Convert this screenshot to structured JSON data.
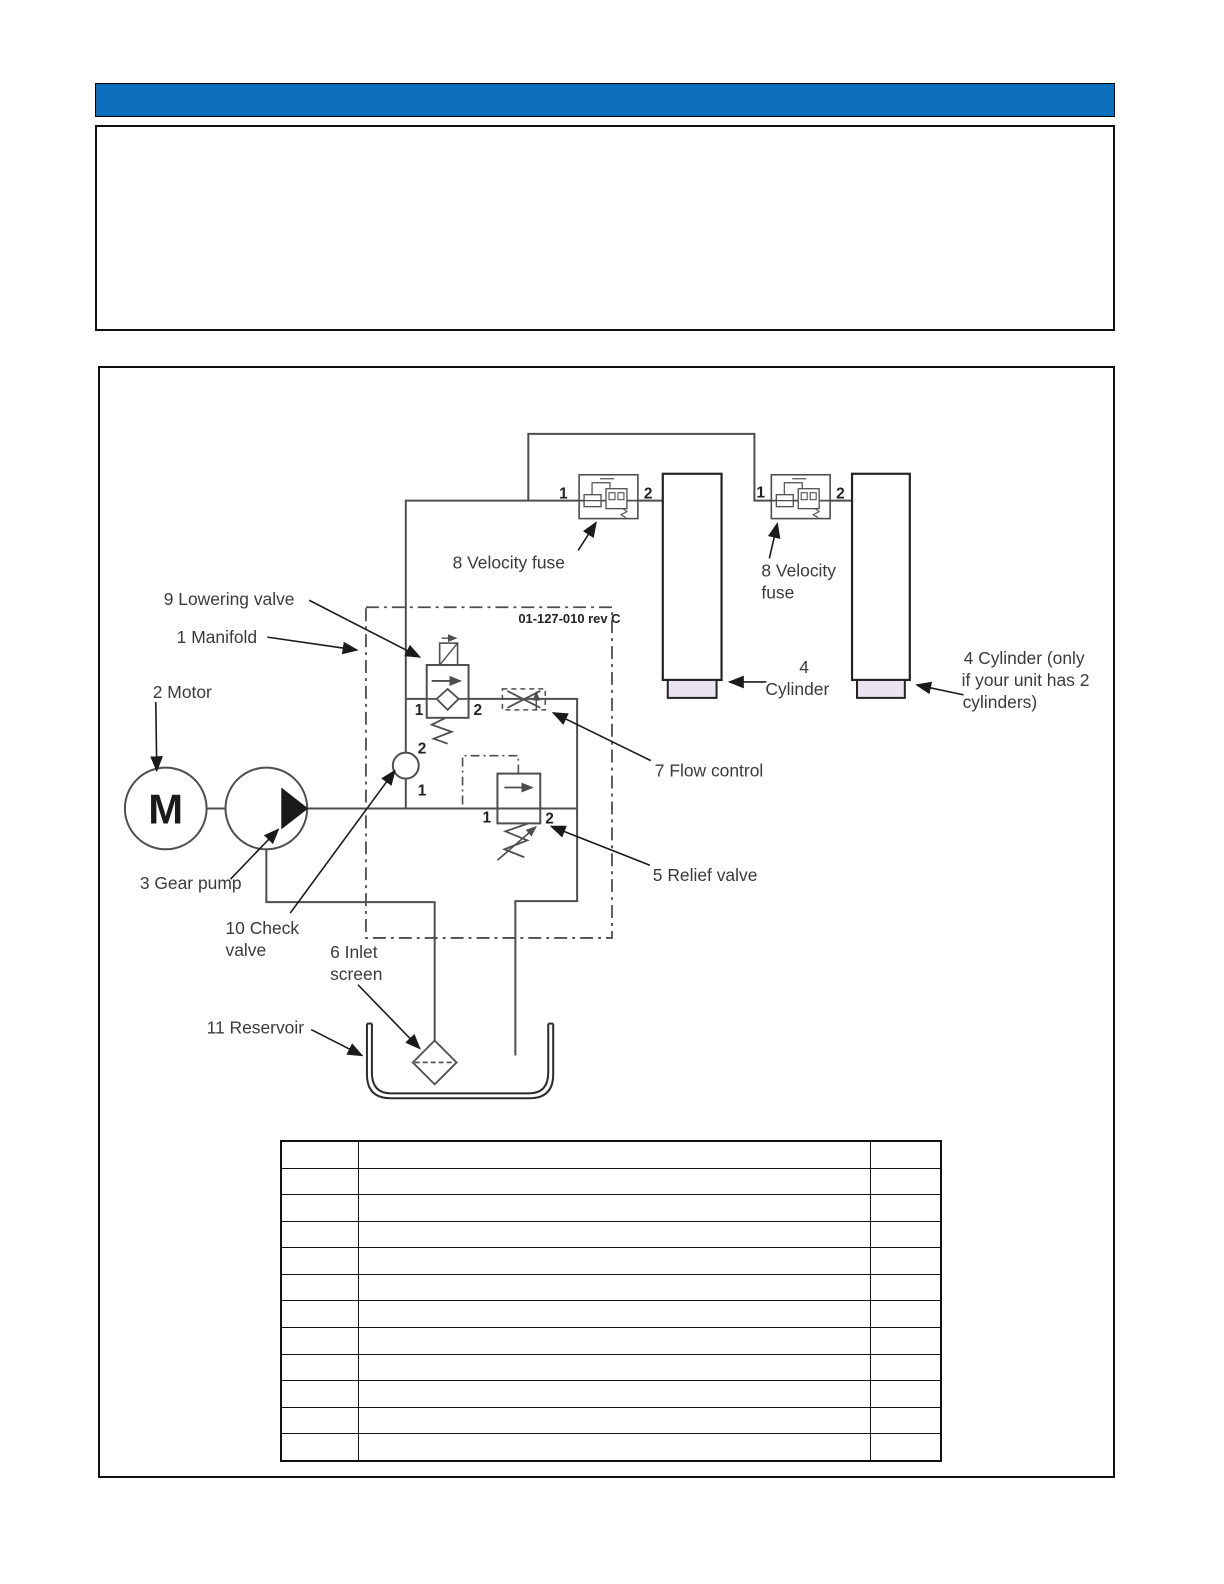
{
  "header": {
    "bar_color": "#0b6fbd"
  },
  "colors": {
    "accent_blue": "#0b6fbd",
    "line_gray": "#4e4e4e",
    "ink": "#1a1a1a",
    "gland_fill": "#e9e4ef"
  },
  "diagram": {
    "drawing_number": "01-127-010 rev C",
    "labels": {
      "lowering_valve": "9 Lowering valve",
      "manifold": "1 Manifold",
      "motor": "2 Motor",
      "motor_letter": "M",
      "gear_pump": "3 Gear pump",
      "check_valve_l1": "10 Check",
      "check_valve_l2": "valve",
      "inlet_screen_l1": "6 Inlet",
      "inlet_screen_l2": "screen",
      "reservoir": "11 Reservoir",
      "velocity_fuse_left": "8 Velocity fuse",
      "velocity_fuse_right_l1": "8 Velocity",
      "velocity_fuse_right_l2": "fuse",
      "flow_control": "7 Flow control",
      "relief_valve": "5 Relief valve",
      "cylinder_l1": "4",
      "cylinder_l2": "Cylinder",
      "cylinder2_l1": "4 Cylinder (only",
      "cylinder2_l2": "if your unit has 2",
      "cylinder2_l3": "cylinders)"
    },
    "ports": {
      "one": "1",
      "two": "2"
    }
  },
  "table": {
    "row_count": 12,
    "column_count": 3,
    "empty_cell": ""
  }
}
